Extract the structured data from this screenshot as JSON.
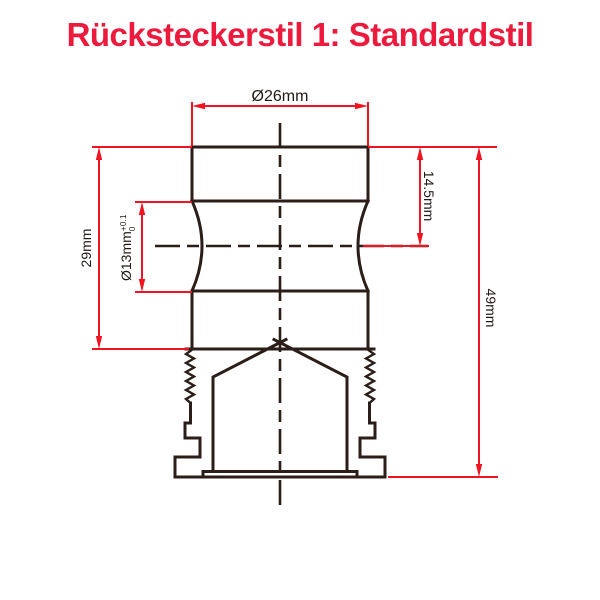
{
  "title": "Rücksteckerstil 1: Standardstil",
  "drawing": {
    "dim_top_diameter": "Ø26mm",
    "dim_center_offset": "14.5mm",
    "dim_total_height": "49mm",
    "dim_body_height": "29mm",
    "dim_inner_diameter_base": "Ø13mm",
    "dim_inner_diameter_tol_upper": "+0.1",
    "dim_inner_diameter_tol_lower": "0"
  },
  "colors": {
    "title_red": "#EC1B3D",
    "dimension_red": "#F01423",
    "outline_black": "#2B1D17"
  }
}
